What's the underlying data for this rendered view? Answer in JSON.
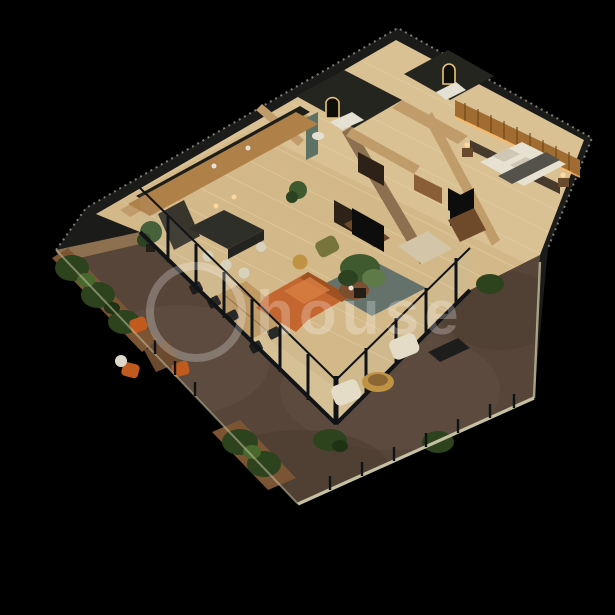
{
  "scene": {
    "type": "3d-isometric-floor-plan-render",
    "rooms": [
      "terrace",
      "living-room",
      "dining-area",
      "kitchen",
      "hallway",
      "bathroom",
      "ensuite-bathroom",
      "walk-in-room",
      "master-bedroom"
    ]
  },
  "watermark": {
    "text": "house",
    "color": "rgba(255,255,255,0.25)"
  },
  "palette": {
    "background": "#000000",
    "wall_dark": "#1b1b19",
    "wall_edge_speckle": "#8f8f85",
    "wall_beige": "#c19c6b",
    "wall_beige_dark": "#8d7050",
    "floor_wood": "#d9c193",
    "floor_wood_dark": "#cdb07e",
    "plank_line": "#e8d5ac",
    "terrace_floor": "#57453a",
    "terrace_patch_light": "#6b564a",
    "terrace_patch_dark": "#463428",
    "glass_frame": "#111417",
    "glass_tint": "rgba(180,200,210,0.07)",
    "railing_cap": "#c6c0a2",
    "hedge": "#2c431d",
    "hedge_dark": "#1f3314",
    "hedge_light": "#49682c",
    "planter_wood": "#7b5433",
    "sofa": "#c4662f",
    "sofa_dark": "#9e5222",
    "sofa_light": "#da7f42",
    "rug_teal": "#5f6e6a",
    "rug_cream": "#d3c6a8",
    "dining_wood": "#c09a62",
    "chair_dark": "#1c1c1a",
    "island_dark": "#2f2f2a",
    "island_side": "#232320",
    "stool_cream": "#d8d2bd",
    "cabinet_wood": "#b08049",
    "backsplash_dark": "#1e1e18",
    "unit_dark": "#3a352c",
    "armchair_green": "#77743c",
    "pouf_gold": "#c09243",
    "coffee_table": "#7d4e30",
    "tv_dark": "#0d0d0d",
    "console_wood": "#6e4a2a",
    "shelf_wood": "#2e2218",
    "plant": "#3f5a2f",
    "plant_dark": "#2c4220",
    "plant_light": "#5d7a47",
    "pot": "#241d16",
    "bed_linen": "#e7e1d1",
    "pillow": "#cfc7b4",
    "throw": "#55524b",
    "headboard": "#473a2c",
    "slat_wood": "#a06c31",
    "slat_line": "#6e4518",
    "led_glow": "#ffb763",
    "lamp_glow": "#ffd9a0",
    "nightstand_wood": "#6a4a2c",
    "bath_dark": "#23251e",
    "teal_wall": "#5c7265",
    "vanity_white": "#e4e0d4",
    "mirror_glow": "#e9c57b",
    "armchair_cream": "#e4dcc6",
    "outdoor_chair_orange": "#c05a1e",
    "outdoor_table_wood": "#6b4a2e",
    "side_table_white": "#dcd8cc",
    "bench_dark": "#1d1d1b",
    "wardrobe_wood": "#8a5f38"
  }
}
